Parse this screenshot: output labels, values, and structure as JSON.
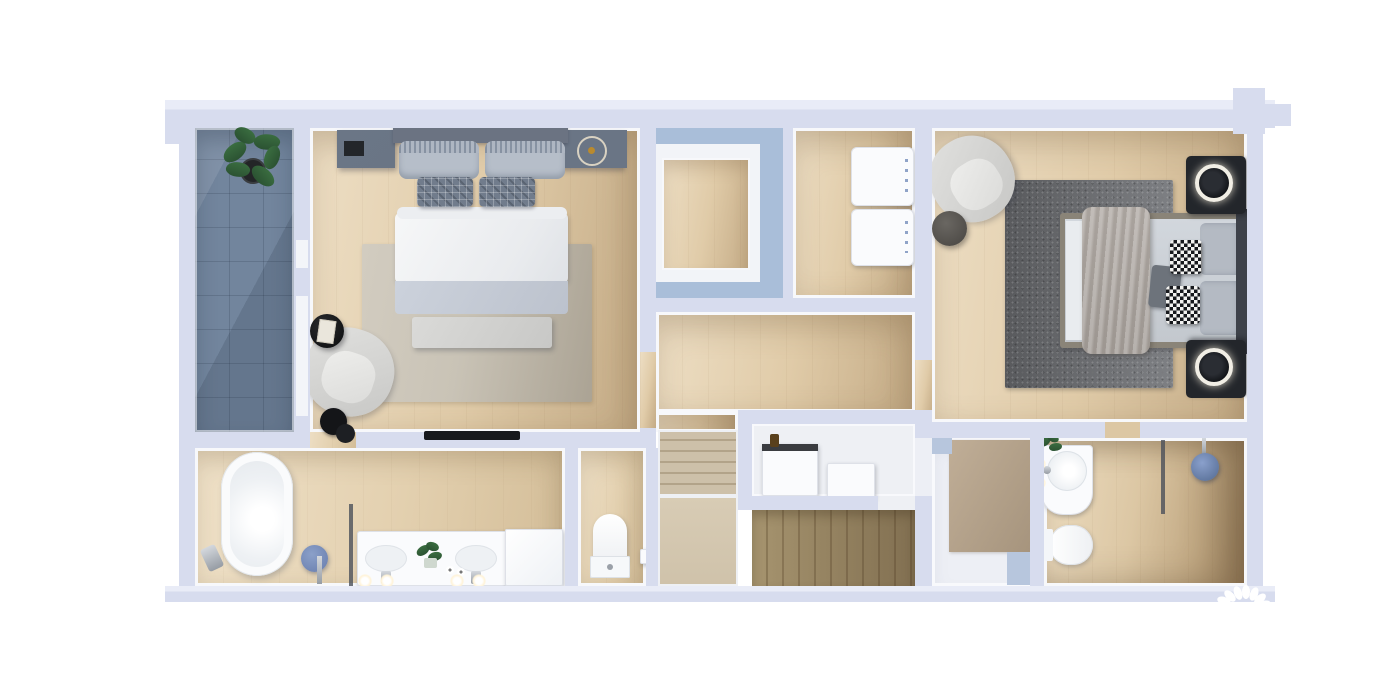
{
  "meta": {
    "title": "3D Floor Plan Render — Upper Floor",
    "type": "architectural-3d-floor-plan",
    "view": "top-down orthographic render",
    "visible_text": "none"
  },
  "canvas": {
    "width": 1383,
    "height": 692,
    "background": "#ffffff"
  },
  "palette": {
    "wall": "#d7dcee",
    "wall_light": "#e9ecf7",
    "interior_face": "#f7f8fb",
    "wood_light": "#eddec4",
    "wood": "#e0cba8",
    "wood_dark": "#c3aa85",
    "stair_dark_wood": "#8d7a58",
    "slate_tile": "#72859d",
    "glass_blue": "#a9bed9",
    "rug_beige": "#c9c3b6",
    "rug_dark_gray": "#76787c",
    "fabric_gray": "#b6bec9",
    "fabric_dark": "#6e7888",
    "linen_white": "#f2f3f5",
    "furniture_white": "#fafbfd",
    "black": "#17191d",
    "plant_green": "#33603a",
    "accent_blue": "#7287b5",
    "glow_warm": "#fff3d8"
  },
  "rooms": [
    {
      "id": "balcony",
      "name": "Balcony",
      "floor": "blue slate tile",
      "items": [
        "potted plant"
      ]
    },
    {
      "id": "master-bedroom",
      "name": "Master bedroom (left)",
      "floor": "light oak",
      "items": [
        "double bed with gray pillows and plaid cushions",
        "left nightstand with tray",
        "right nightstand with round clock",
        "bed-end bench",
        "beige area rug",
        "lounge armchair",
        "round black side table with open book",
        "black side stool",
        "wall-mounted TV"
      ]
    },
    {
      "id": "walk-in-closet",
      "name": "Walk-in closet (top middle)",
      "floor": "oak inset",
      "items": [
        "blue glazed partition band"
      ]
    },
    {
      "id": "laundry",
      "name": "Laundry / utility room",
      "floor": "light oak",
      "items": [
        "stacked washer",
        "stacked dryer"
      ]
    },
    {
      "id": "bedroom-2",
      "name": "Bedroom 2 (right)",
      "floor": "light oak",
      "items": [
        "double bed with taupe throw and houndstooth cushions",
        "black nightstand with ring lamp (top)",
        "black nightstand with ring lamp (bottom)",
        "dark gray area rug",
        "curved lounge chair",
        "round dark ottoman"
      ]
    },
    {
      "id": "hallway",
      "name": "Hallway landing",
      "floor": "light oak",
      "items": []
    },
    {
      "id": "staircase",
      "name": "Staircase",
      "floor": "oak treads",
      "items": [
        "upper flight",
        "half landing",
        "lower dark flight",
        "storage nook with two white cabinets and a bottle"
      ]
    },
    {
      "id": "family-bathroom",
      "name": "Family bathroom (bottom left)",
      "floor": "pale oak",
      "items": [
        "freestanding oval bathtub",
        "tub filler faucet",
        "blue round stool",
        "glass shower screen",
        "double vanity with two basins",
        "vanity plant",
        "two candles",
        "four glowing sconce lights",
        "tall white cabinet"
      ]
    },
    {
      "id": "wc",
      "name": "Separate WC",
      "floor": "pale oak",
      "items": [
        "toilet",
        "toilet-paper holder"
      ]
    },
    {
      "id": "ensuite-bathroom",
      "name": "En-suite bathroom (bottom right)",
      "floor": "oak + white",
      "items": [
        "tan dressing rug",
        "blue bath mat",
        "blue threshold",
        "round-basin vanity",
        "two glowing wall lamps",
        "small plant",
        "toilet",
        "glass shower screen",
        "rain shower with blue head"
      ]
    }
  ],
  "watermark": {
    "shape": "petal-fan logo",
    "petals": 7,
    "color": "#ffffff",
    "position": "bottom-right wall"
  }
}
